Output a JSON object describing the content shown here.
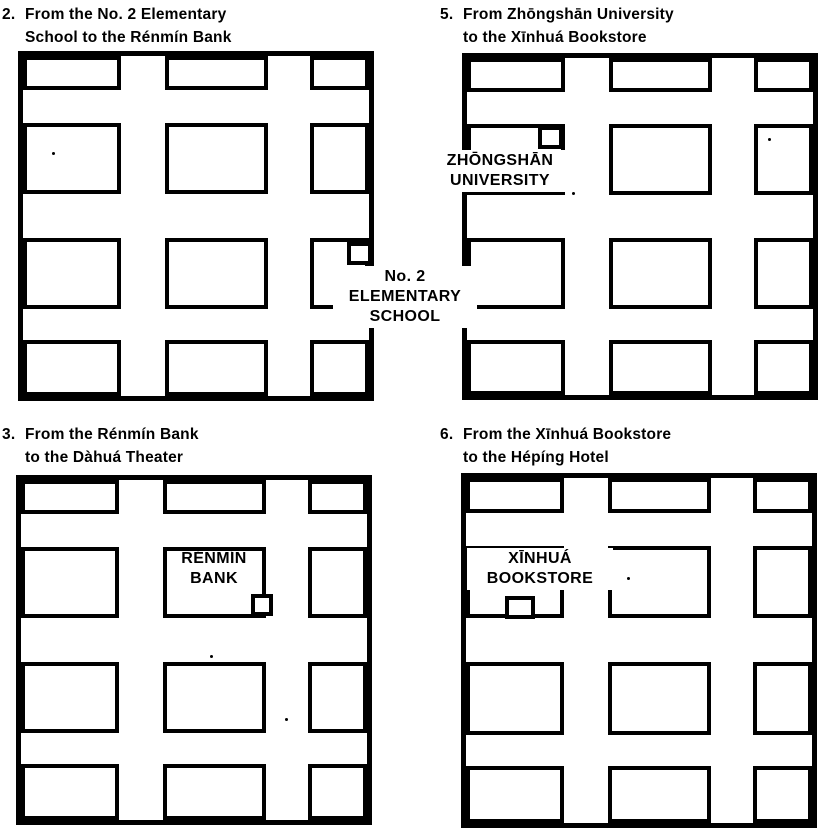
{
  "colors": {
    "ink": "#000000",
    "paper": "#ffffff"
  },
  "exercises": [
    {
      "number": "2.",
      "title": [
        "From the No. 2 Elementary",
        "School to the Rénmín Bank"
      ],
      "place": {
        "label_lines": [
          "No. 2",
          "ELEMENTARY",
          "SCHOOL"
        ],
        "marker_block": "row 3, column 3",
        "marker_position": "top-right corner of block, label outside map right edge"
      }
    },
    {
      "number": "3.",
      "title": [
        "From the Rénmín Bank",
        "to the Dàhuá Theater"
      ],
      "place": {
        "label_lines": [
          "RÉNMÍN",
          "BANK"
        ],
        "marker_block": "row 2, column 2",
        "marker_position": "bottom-right corner of block, label inside block"
      }
    },
    {
      "number": "5.",
      "title": [
        "From Zhōngshān University",
        "to the Xīnhuá Bookstore"
      ],
      "place": {
        "label_lines": [
          "ZHŌNGSHĀN",
          "UNIVERSITY"
        ],
        "marker_block": "row 2, column 1",
        "marker_position": "top-right corner of block, label crossing map left edge"
      }
    },
    {
      "number": "6.",
      "title": [
        "From the Xīnhuá Bookstore",
        "to the Hépíng Hotel"
      ],
      "place": {
        "label_lines": [
          "XĪNHUÁ",
          "BOOKSTORE"
        ],
        "marker_block": "row 2, column 1",
        "marker_position": "bottom edge of block, centered under label"
      }
    }
  ],
  "map_structure": {
    "blocks_per_map": 12,
    "grid": "3 columns × 4 rows of city blocks separated by streets, edge blocks touch the outer border"
  }
}
